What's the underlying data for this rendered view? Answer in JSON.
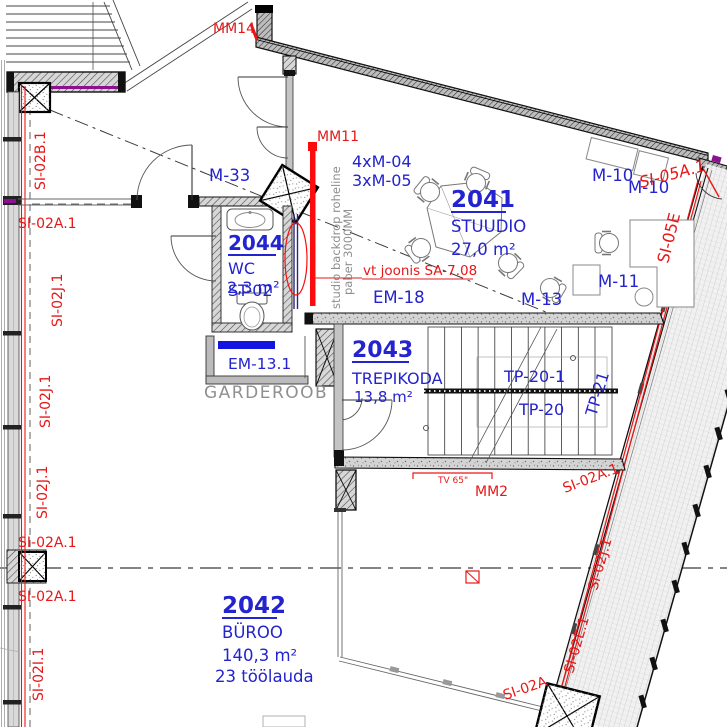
{
  "drawing_type": "floor-plan",
  "rooms": {
    "studio": {
      "number": "2041",
      "name": "STUUDIO",
      "area": "27,0 m²"
    },
    "byroo": {
      "number": "2042",
      "name": "BÜROO",
      "area": "140,3 m²",
      "desks": "23 töölauda"
    },
    "trepikoda": {
      "number": "2043",
      "name": "TREPIKODA",
      "area": "13,8 m²"
    },
    "wc": {
      "number": "2044",
      "name": "WC",
      "area": "2,3 m²",
      "overlay_code": "ST-02"
    }
  },
  "equipment": {
    "m33": "M-33",
    "m10_1": "M-10",
    "m10_2": "M-10",
    "m11": "M-11",
    "m13": "M-13",
    "m04_qty": "4xM-04",
    "m05_qty": "3xM-05",
    "em18": "EM-18",
    "em13_1": "EM-13.1",
    "tp20_1": "TP-20-1",
    "tp20": "TP-20",
    "tp21": "TP-21"
  },
  "markers": {
    "mm14": "MM14",
    "mm11": "MM11",
    "mm2": "MM2",
    "tv": "TV 65\""
  },
  "notes": {
    "backdrop1": "studio backdrop roheline",
    "backdrop2": "paber 3000MM",
    "see_drawing": "vt joonis SA-7.08",
    "garderoob": "GARDEROOB"
  },
  "section_marks": {
    "left": [
      "SI-02B.1",
      "SI-02A.1",
      "SI-02J.1",
      "SI-02J.1",
      "SI-02J.1",
      "SI-02A.1",
      "SI-02A.1",
      "SI-02I.1"
    ],
    "right_top": [
      "SI-05A.1",
      "SI-05E"
    ],
    "right_bottom": [
      "SI-02A.1",
      "SI-02J.1",
      "SI-02E.1",
      "SI-02A"
    ]
  },
  "colors": {
    "label_blue": "#2323cf",
    "mark_red": "#e81717",
    "note_gray": "#8f8f8f",
    "backdrop_red": "#fb0d0d",
    "insulation_purple": "#8c1190"
  }
}
